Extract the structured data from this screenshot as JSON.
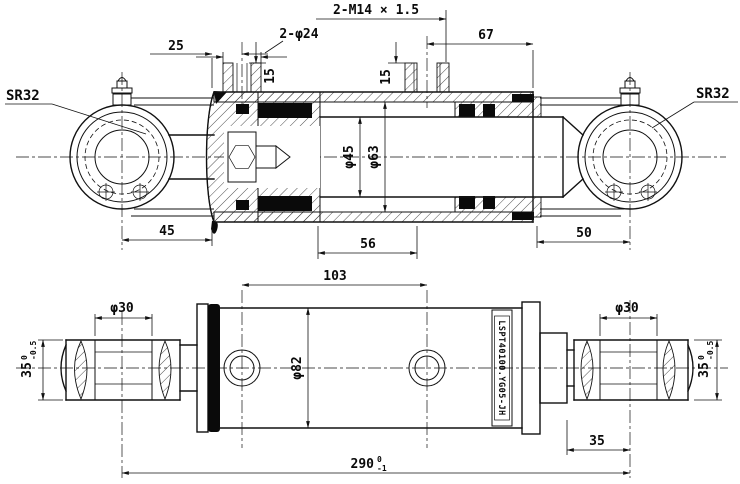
{
  "drawing": {
    "background_color": "#ffffff",
    "line_color": "#111111",
    "nameplate": "LSPT40100.YG05-JH",
    "upper_view": {
      "sr32_left": "SR32",
      "sr32_right": "SR32",
      "dim_25": "25",
      "dim_2_phi24": "2-φ24",
      "dim_15_left": "15",
      "dim_15_right": "15",
      "dim_2_m14": "2-M14 × 1.5",
      "dim_67": "67",
      "dim_phi45": "φ45",
      "dim_phi63": "φ63",
      "dim_45": "45",
      "dim_56": "56",
      "dim_50": "50"
    },
    "lower_view": {
      "dim_phi30_left": "φ30",
      "dim_phi30_right": "φ30",
      "eye_width": {
        "main": "35",
        "tol_upper": "0",
        "tol_lower": "-0.5"
      },
      "dim_103": "103",
      "dim_phi82": "φ82",
      "dim_35": "35",
      "overall_length": {
        "main": "290",
        "tol_upper": "0",
        "tol_lower": "-1"
      }
    }
  }
}
